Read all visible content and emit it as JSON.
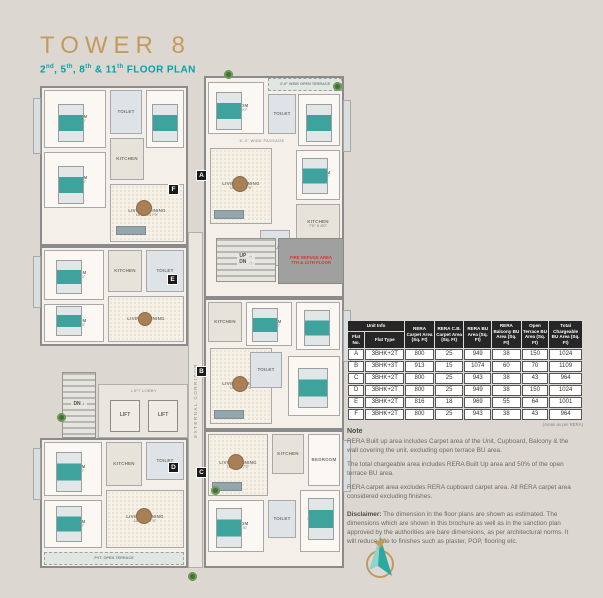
{
  "header": {
    "title": "TOWER 8",
    "subtitle_parts": [
      [
        "2",
        "nd"
      ],
      [
        ", 5",
        "th"
      ],
      [
        ", 8",
        "th"
      ],
      [
        " & 11",
        "th"
      ],
      [
        " FLOOR PLAN",
        ""
      ]
    ]
  },
  "floor_plan": {
    "elements": [
      {
        "n": "unit-f-outline",
        "c": "unit",
        "x": 40,
        "y": 86,
        "w": 148,
        "h": 160
      },
      {
        "n": "unit-a-outline",
        "c": "unit",
        "x": 204,
        "y": 76,
        "w": 140,
        "h": 222
      },
      {
        "n": "unit-e-outline",
        "c": "unit",
        "x": 40,
        "y": 246,
        "w": 148,
        "h": 100
      },
      {
        "n": "unit-b-outline",
        "c": "unit",
        "x": 204,
        "y": 298,
        "w": 140,
        "h": 132
      },
      {
        "n": "unit-d-outline",
        "c": "unit",
        "x": 40,
        "y": 438,
        "w": 148,
        "h": 130
      },
      {
        "n": "unit-c-outline",
        "c": "unit",
        "x": 204,
        "y": 430,
        "w": 140,
        "h": 138
      },
      {
        "n": "balcony",
        "c": "balcony",
        "x": 33,
        "y": 98,
        "w": 8,
        "h": 56
      },
      {
        "n": "balcony",
        "c": "balcony",
        "x": 33,
        "y": 256,
        "w": 8,
        "h": 52
      },
      {
        "n": "balcony",
        "c": "balcony",
        "x": 343,
        "y": 100,
        "w": 8,
        "h": 52
      },
      {
        "n": "balcony",
        "c": "balcony",
        "x": 343,
        "y": 310,
        "w": 8,
        "h": 52
      },
      {
        "n": "balcony",
        "c": "balcony",
        "x": 33,
        "y": 448,
        "w": 8,
        "h": 52
      },
      {
        "n": "balcony",
        "c": "balcony",
        "x": 343,
        "y": 440,
        "w": 8,
        "h": 52
      },
      {
        "n": "bedroom",
        "c": "room",
        "x": 44,
        "y": 90,
        "w": 62,
        "h": 58,
        "t": "BEDROOM",
        "d": "11'0\" X 10'6\""
      },
      {
        "n": "toilet",
        "c": "room toilet",
        "x": 110,
        "y": 90,
        "w": 32,
        "h": 44,
        "t": "TOILET"
      },
      {
        "n": "bedroom",
        "c": "room",
        "x": 146,
        "y": 90,
        "w": 38,
        "h": 58,
        "t": "BEDROOM",
        "d": "10'0\" X 11'6\""
      },
      {
        "n": "bedroom",
        "c": "room",
        "x": 44,
        "y": 152,
        "w": 62,
        "h": 56,
        "t": "BEDROOM",
        "d": "10'0\" X 11'3\""
      },
      {
        "n": "kitchen",
        "c": "room kitchen",
        "x": 110,
        "y": 138,
        "w": 34,
        "h": 42,
        "t": "KITCHEN"
      },
      {
        "n": "living-dining",
        "c": "room dining",
        "x": 110,
        "y": 184,
        "w": 74,
        "h": 58,
        "t": "LIVING / DINING",
        "d": "10'6\" X 17'0\""
      },
      {
        "n": "open-terrace",
        "c": "terrace",
        "x": 268,
        "y": 78,
        "w": 74,
        "h": 13,
        "t": "4'-0\" WIDE OPEN TERRACE"
      },
      {
        "n": "bedroom",
        "c": "room",
        "x": 208,
        "y": 82,
        "w": 56,
        "h": 52,
        "t": "BEDROOM",
        "d": "11'0\" X 10'0\""
      },
      {
        "n": "toilet",
        "c": "room toilet",
        "x": 268,
        "y": 94,
        "w": 28,
        "h": 40,
        "t": "TOILET"
      },
      {
        "n": "bedroom",
        "c": "room",
        "x": 298,
        "y": 94,
        "w": 42,
        "h": 52,
        "t": "BEDROOM",
        "d": "10'0\" X 11'6\""
      },
      {
        "n": "passage-label",
        "c": "plabel",
        "x": 224,
        "y": 138,
        "w": 76,
        "h": 7,
        "t": "6'-0\" WIDE PASSAGE"
      },
      {
        "n": "living-dining",
        "c": "room dining",
        "x": 210,
        "y": 148,
        "w": 62,
        "h": 76,
        "t": "LIVING / DINING",
        "d": "10'6\" X 17'0\""
      },
      {
        "n": "bedroom",
        "c": "room",
        "x": 296,
        "y": 150,
        "w": 44,
        "h": 50,
        "t": "BEDROOM",
        "d": "10'0\" X 10'6\""
      },
      {
        "n": "kitchen",
        "c": "room kitchen",
        "x": 296,
        "y": 204,
        "w": 44,
        "h": 40,
        "t": "KITCHEN",
        "d": "7'0\" X 8'0\""
      },
      {
        "n": "toilet",
        "c": "room toilet",
        "x": 260,
        "y": 230,
        "w": 30,
        "h": 36,
        "t": "TOILET"
      },
      {
        "n": "bedroom",
        "c": "room",
        "x": 44,
        "y": 250,
        "w": 60,
        "h": 50,
        "t": "BEDROOM",
        "d": "10'0\" X 11'0\""
      },
      {
        "n": "kitchen",
        "c": "room kitchen",
        "x": 108,
        "y": 250,
        "w": 34,
        "h": 42,
        "t": "KITCHEN"
      },
      {
        "n": "toilet",
        "c": "room toilet",
        "x": 146,
        "y": 250,
        "w": 38,
        "h": 42,
        "t": "TOILET"
      },
      {
        "n": "bedroom",
        "c": "room",
        "x": 44,
        "y": 304,
        "w": 60,
        "h": 38,
        "t": "BEDROOM",
        "d": "10'0\" X 10'0\""
      },
      {
        "n": "living-dining",
        "c": "room dining",
        "x": 108,
        "y": 296,
        "w": 76,
        "h": 46,
        "t": "LIVING / DINING"
      },
      {
        "n": "kitchen",
        "c": "room kitchen",
        "x": 208,
        "y": 302,
        "w": 34,
        "h": 40,
        "t": "KITCHEN"
      },
      {
        "n": "bedroom",
        "c": "room",
        "x": 246,
        "y": 302,
        "w": 46,
        "h": 44,
        "t": "BEDROOM",
        "d": "10'0\" X 10'6\""
      },
      {
        "n": "bedroom",
        "c": "room",
        "x": 296,
        "y": 302,
        "w": 44,
        "h": 48,
        "t": "BEDROOM",
        "d": "10'0\" X 11'0\""
      },
      {
        "n": "living-dining",
        "c": "room dining",
        "x": 210,
        "y": 348,
        "w": 62,
        "h": 76,
        "t": "LIVING / DINING",
        "d": "10'6\" X 17'0\""
      },
      {
        "n": "toilet",
        "c": "room toilet",
        "x": 250,
        "y": 352,
        "w": 32,
        "h": 36,
        "t": "TOILET"
      },
      {
        "n": "bedroom",
        "c": "room",
        "x": 288,
        "y": 356,
        "w": 52,
        "h": 60,
        "t": "BEDROOM",
        "d": "11'0\" X 10'0\""
      },
      {
        "n": "bedroom",
        "c": "room",
        "x": 44,
        "y": 442,
        "w": 58,
        "h": 54,
        "t": "BEDROOM",
        "d": "11'0\" X 10'6\""
      },
      {
        "n": "kitchen",
        "c": "room kitchen",
        "x": 106,
        "y": 442,
        "w": 36,
        "h": 44,
        "t": "KITCHEN"
      },
      {
        "n": "toilet",
        "c": "room toilet",
        "x": 146,
        "y": 442,
        "w": 38,
        "h": 38,
        "t": "TOILET"
      },
      {
        "n": "living-dining",
        "c": "room dining",
        "x": 106,
        "y": 490,
        "w": 78,
        "h": 58,
        "t": "LIVING / DINING",
        "d": "10'6\" X 17'0\""
      },
      {
        "n": "bedroom",
        "c": "room",
        "x": 44,
        "y": 500,
        "w": 58,
        "h": 48,
        "t": "BEDROOM",
        "d": "10'0\" X 11'0\""
      },
      {
        "n": "open-terrace",
        "c": "terrace",
        "x": 44,
        "y": 552,
        "w": 140,
        "h": 13,
        "t": "PVT. OPEN TERRACE"
      },
      {
        "n": "living-dining",
        "c": "room dining",
        "x": 208,
        "y": 434,
        "w": 60,
        "h": 62,
        "t": "LIVING / DINING",
        "d": "10'6\" X 17'0\""
      },
      {
        "n": "kitchen",
        "c": "room kitchen",
        "x": 272,
        "y": 434,
        "w": 32,
        "h": 40,
        "t": "KITCHEN"
      },
      {
        "n": "bedroom",
        "c": "room",
        "x": 308,
        "y": 434,
        "w": 32,
        "h": 52,
        "t": "BEDROOM"
      },
      {
        "n": "bedroom",
        "c": "room",
        "x": 208,
        "y": 500,
        "w": 56,
        "h": 52,
        "t": "BEDROOM",
        "d": "10'0\" X 11'6\""
      },
      {
        "n": "toilet",
        "c": "room toilet",
        "x": 268,
        "y": 500,
        "w": 28,
        "h": 38,
        "t": "TOILET"
      },
      {
        "n": "bedroom",
        "c": "room",
        "x": 300,
        "y": 490,
        "w": 40,
        "h": 62,
        "t": "BEDROOM",
        "d": "10'0\" X 10'6\""
      },
      {
        "n": "staircase-up-down",
        "c": "stair",
        "x": 216,
        "y": 238,
        "w": 60,
        "h": 44,
        "t": "UP →",
        "d": "DN →"
      },
      {
        "n": "fire-refuge-area",
        "c": "fire",
        "x": 278,
        "y": 238,
        "w": 66,
        "h": 46,
        "t": "FIRE REFUGE AREA",
        "d": "7TH & 11TH FLOOR"
      },
      {
        "n": "external-corridor",
        "c": "corridor",
        "x": 188,
        "y": 232,
        "w": 15,
        "h": 336,
        "t": "EXTERNAL CORRIDOR"
      },
      {
        "n": "staircase-left",
        "c": "stair",
        "x": 62,
        "y": 372,
        "w": 34,
        "h": 66,
        "t": "DN ↓"
      },
      {
        "n": "lift-lobby",
        "c": "corridor",
        "x": 98,
        "y": 384,
        "w": 90,
        "h": 54
      },
      {
        "n": "lift-lobby-label",
        "c": "plabel",
        "x": 104,
        "y": 387,
        "w": 80,
        "h": 8,
        "t": "LIFT LOBBY"
      },
      {
        "n": "lift-1",
        "c": "lift",
        "x": 110,
        "y": 400,
        "w": 30,
        "h": 32,
        "t": "LIFT"
      },
      {
        "n": "lift-2",
        "c": "lift",
        "x": 148,
        "y": 400,
        "w": 30,
        "h": 32,
        "t": "LIFT"
      },
      {
        "n": "bed",
        "c": "bed",
        "x": 58,
        "y": 104,
        "w": 26,
        "h": 38
      },
      {
        "n": "bed",
        "c": "bed",
        "x": 152,
        "y": 104,
        "w": 26,
        "h": 38
      },
      {
        "n": "bed",
        "c": "bed",
        "x": 58,
        "y": 166,
        "w": 26,
        "h": 38
      },
      {
        "n": "bed",
        "c": "bed",
        "x": 216,
        "y": 92,
        "w": 26,
        "h": 38
      },
      {
        "n": "bed",
        "c": "bed",
        "x": 306,
        "y": 104,
        "w": 26,
        "h": 38
      },
      {
        "n": "bed",
        "c": "bed",
        "x": 302,
        "y": 158,
        "w": 26,
        "h": 36
      },
      {
        "n": "bed",
        "c": "bed",
        "x": 56,
        "y": 260,
        "w": 26,
        "h": 34
      },
      {
        "n": "bed",
        "c": "bed",
        "x": 56,
        "y": 306,
        "w": 26,
        "h": 30
      },
      {
        "n": "bed",
        "c": "bed",
        "x": 252,
        "y": 308,
        "w": 26,
        "h": 34
      },
      {
        "n": "bed",
        "c": "bed",
        "x": 304,
        "y": 310,
        "w": 26,
        "h": 36
      },
      {
        "n": "bed",
        "c": "bed",
        "x": 298,
        "y": 368,
        "w": 30,
        "h": 40
      },
      {
        "n": "bed",
        "c": "bed",
        "x": 56,
        "y": 452,
        "w": 26,
        "h": 40
      },
      {
        "n": "bed",
        "c": "bed",
        "x": 56,
        "y": 506,
        "w": 26,
        "h": 36
      },
      {
        "n": "bed",
        "c": "bed",
        "x": 216,
        "y": 508,
        "w": 26,
        "h": 40
      },
      {
        "n": "bed",
        "c": "bed",
        "x": 308,
        "y": 498,
        "w": 26,
        "h": 42
      },
      {
        "n": "dining-table",
        "c": "tbl-round",
        "x": 136,
        "y": 200,
        "w": 16,
        "h": 16
      },
      {
        "n": "dining-table",
        "c": "tbl-round",
        "x": 232,
        "y": 176,
        "w": 16,
        "h": 16
      },
      {
        "n": "dining-table",
        "c": "tbl-round",
        "x": 138,
        "y": 312,
        "w": 14,
        "h": 14
      },
      {
        "n": "dining-table",
        "c": "tbl-round",
        "x": 232,
        "y": 376,
        "w": 16,
        "h": 16
      },
      {
        "n": "dining-table",
        "c": "tbl-round",
        "x": 136,
        "y": 508,
        "w": 16,
        "h": 16
      },
      {
        "n": "dining-table",
        "c": "tbl-round",
        "x": 228,
        "y": 454,
        "w": 16,
        "h": 16
      },
      {
        "n": "sofa",
        "c": "sofa",
        "x": 116,
        "y": 226,
        "w": 30,
        "h": 9
      },
      {
        "n": "sofa",
        "c": "sofa",
        "x": 214,
        "y": 210,
        "w": 30,
        "h": 9
      },
      {
        "n": "sofa",
        "c": "sofa",
        "x": 214,
        "y": 410,
        "w": 30,
        "h": 9
      },
      {
        "n": "sofa",
        "c": "sofa",
        "x": 212,
        "y": 482,
        "w": 30,
        "h": 9
      },
      {
        "n": "plant",
        "c": "plant",
        "x": 224,
        "y": 70,
        "w": 9,
        "h": 9
      },
      {
        "n": "plant",
        "c": "plant",
        "x": 333,
        "y": 82,
        "w": 9,
        "h": 9
      },
      {
        "n": "plant",
        "c": "plant",
        "x": 57,
        "y": 413,
        "w": 9,
        "h": 9
      },
      {
        "n": "plant",
        "c": "plant",
        "x": 188,
        "y": 572,
        "w": 9,
        "h": 9
      },
      {
        "n": "plant",
        "c": "plant",
        "x": 211,
        "y": 486,
        "w": 9,
        "h": 9
      },
      {
        "n": "unit-marker-a",
        "c": "marker",
        "x": 196,
        "y": 170,
        "w": 11,
        "h": 11,
        "t": "A"
      },
      {
        "n": "unit-marker-f",
        "c": "marker",
        "x": 168,
        "y": 184,
        "w": 11,
        "h": 11,
        "t": "F"
      },
      {
        "n": "unit-marker-e",
        "c": "marker",
        "x": 167,
        "y": 274,
        "w": 11,
        "h": 11,
        "t": "E"
      },
      {
        "n": "unit-marker-b",
        "c": "marker",
        "x": 196,
        "y": 366,
        "w": 11,
        "h": 11,
        "t": "B"
      },
      {
        "n": "unit-marker-d",
        "c": "marker",
        "x": 168,
        "y": 462,
        "w": 11,
        "h": 11,
        "t": "D"
      },
      {
        "n": "unit-marker-c",
        "c": "marker",
        "x": 196,
        "y": 467,
        "w": 11,
        "h": 11,
        "t": "C"
      }
    ]
  },
  "table": {
    "unit_info_header": "Unit Info",
    "subheaders": [
      "Flat No.",
      "Flat Type"
    ],
    "columns": [
      "RERA Carpet Area (Sq. Ft)",
      "RERA C.B. Carpet Area (Sq. Ft)",
      "RERA BU Area (Sq. Ft)",
      "RERA Balcony BU Area (Sq. Ft)",
      "Open Terrace BU Area (Sq. Ft)",
      "Total Chargeable BU Area (Sq. Ft)"
    ],
    "rows": [
      [
        "A",
        "3BHK+2T",
        "800",
        "25",
        "949",
        "38",
        "150",
        "1024"
      ],
      [
        "B",
        "3BHK+3T",
        "913",
        "15",
        "1074",
        "60",
        "70",
        "1109"
      ],
      [
        "C",
        "3BHK+2T",
        "800",
        "25",
        "943",
        "38",
        "43",
        "964"
      ],
      [
        "D",
        "3BHK+2T",
        "800",
        "25",
        "949",
        "38",
        "150",
        "1024"
      ],
      [
        "E",
        "3BHK+2T",
        "816",
        "18",
        "969",
        "55",
        "64",
        "1001"
      ],
      [
        "F",
        "3BHK+2T",
        "800",
        "25",
        "943",
        "38",
        "43",
        "964"
      ]
    ],
    "footnote": "(Areas as per RERA)"
  },
  "notes": {
    "heading": "Note",
    "paragraphs": [
      "RERA Built up area includes Carpet area of the Unit, Cupboard, Balcony & the wall covering the unit, excluding open terrace BU area.",
      "The total chargeable area includes RERA Built Up area and 50% of the open terrace BU area.",
      "RERA carpet area excludes RERA cupboard carpet area. All RERA carpet area considered excluding finishes."
    ],
    "disclaimer_label": "Disclaimer:",
    "disclaimer_text": " The dimension in the floor plans are shown as estimated. The dimensions which are shown in this brochure as well as in the sanction plan approved by the authorities are bare dimensions, as per architectural norms. It will reduce due to finishes such as plaster, POP, flooring etc."
  }
}
